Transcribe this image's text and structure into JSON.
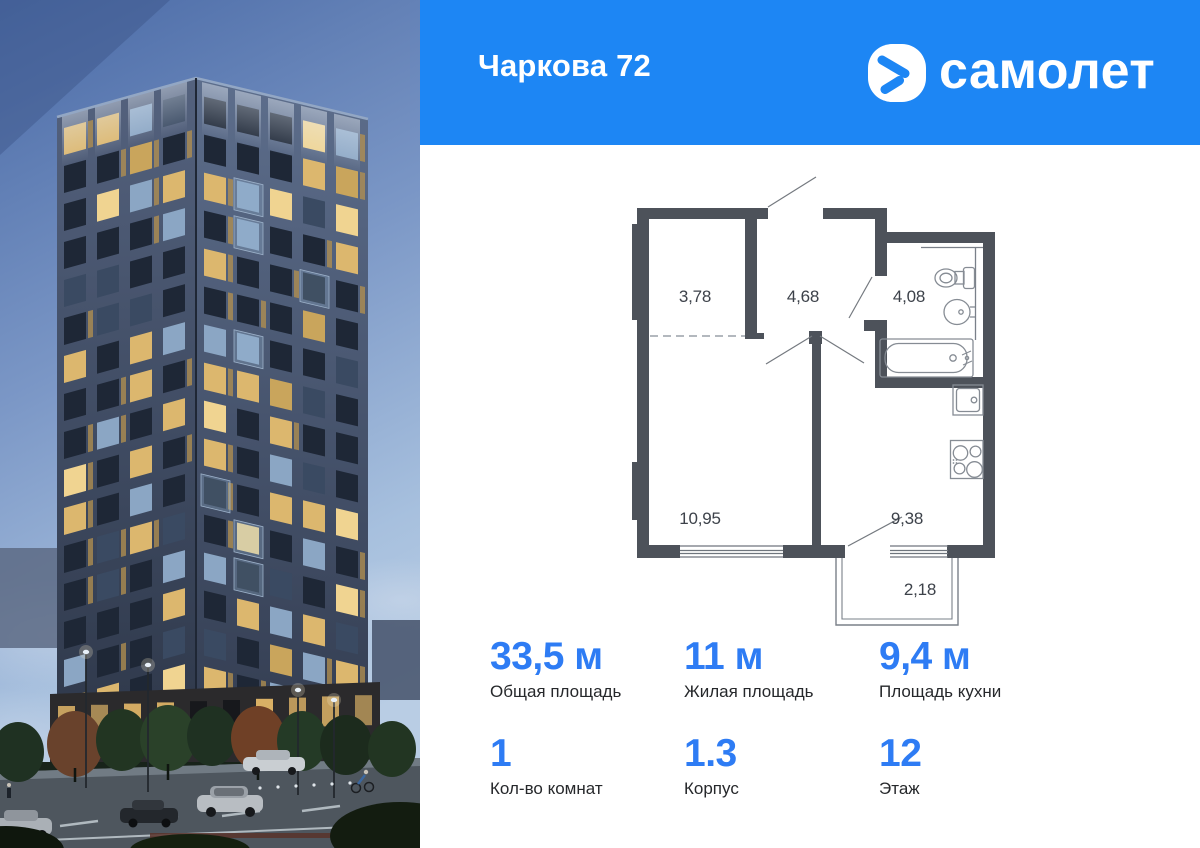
{
  "header": {
    "title": "Чаркова 72",
    "brand": "самолет",
    "bg_color": "#1d86f4"
  },
  "floorplan": {
    "wall_color": "#4d525a",
    "room_areas": [
      "3,78",
      "4,68",
      "4,08",
      "10,95",
      "9,38",
      "2,18"
    ]
  },
  "stats": {
    "accent_color": "#2e7cf4",
    "items": [
      {
        "value": "33,5 м",
        "label": "Общая площадь"
      },
      {
        "value": "11 м",
        "label": "Жилая площадь"
      },
      {
        "value": "9,4 м",
        "label": "Площадь кухни"
      },
      {
        "value": "1",
        "label": "Кол-во комнат"
      },
      {
        "value": "1.3",
        "label": "Корпус"
      },
      {
        "value": "12",
        "label": "Этаж"
      }
    ]
  },
  "photo": {
    "window_palette": [
      "#1e2736",
      "#dcb76e",
      "#8ba6c4",
      "#3a4a62",
      "#f0d491",
      "#c9a55c"
    ],
    "gold_accent": "#b5914f"
  }
}
